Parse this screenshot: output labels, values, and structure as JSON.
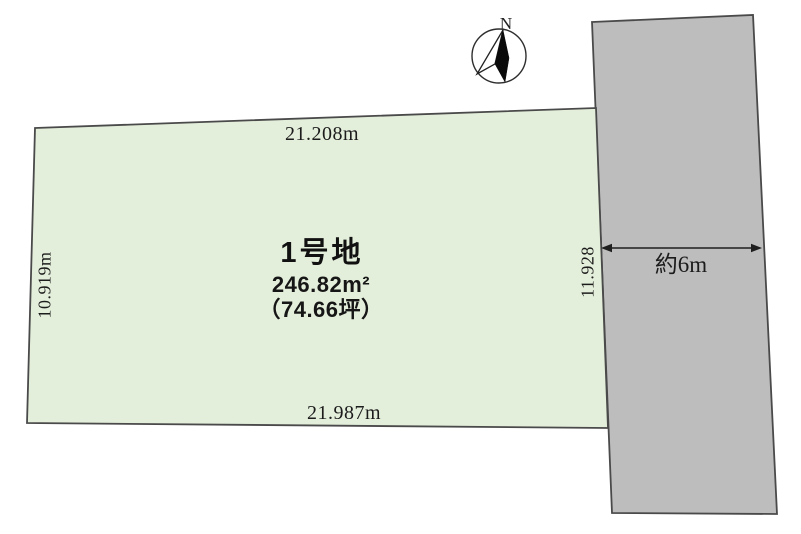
{
  "compass": {
    "north_label": "N"
  },
  "lot": {
    "name": "1号地",
    "area_m2": "246.82m²",
    "area_tsubo": "（74.66坪）",
    "dimensions": {
      "top": "21.208m",
      "left": "10.919m",
      "right": "11.928",
      "bottom": "21.987m"
    }
  },
  "road": {
    "width_label": "約6m"
  },
  "colors": {
    "lot_fill": "#e4efdb",
    "road_fill": "#bdbdbe",
    "outline": "#4a4a4a",
    "background": "#ffffff"
  }
}
